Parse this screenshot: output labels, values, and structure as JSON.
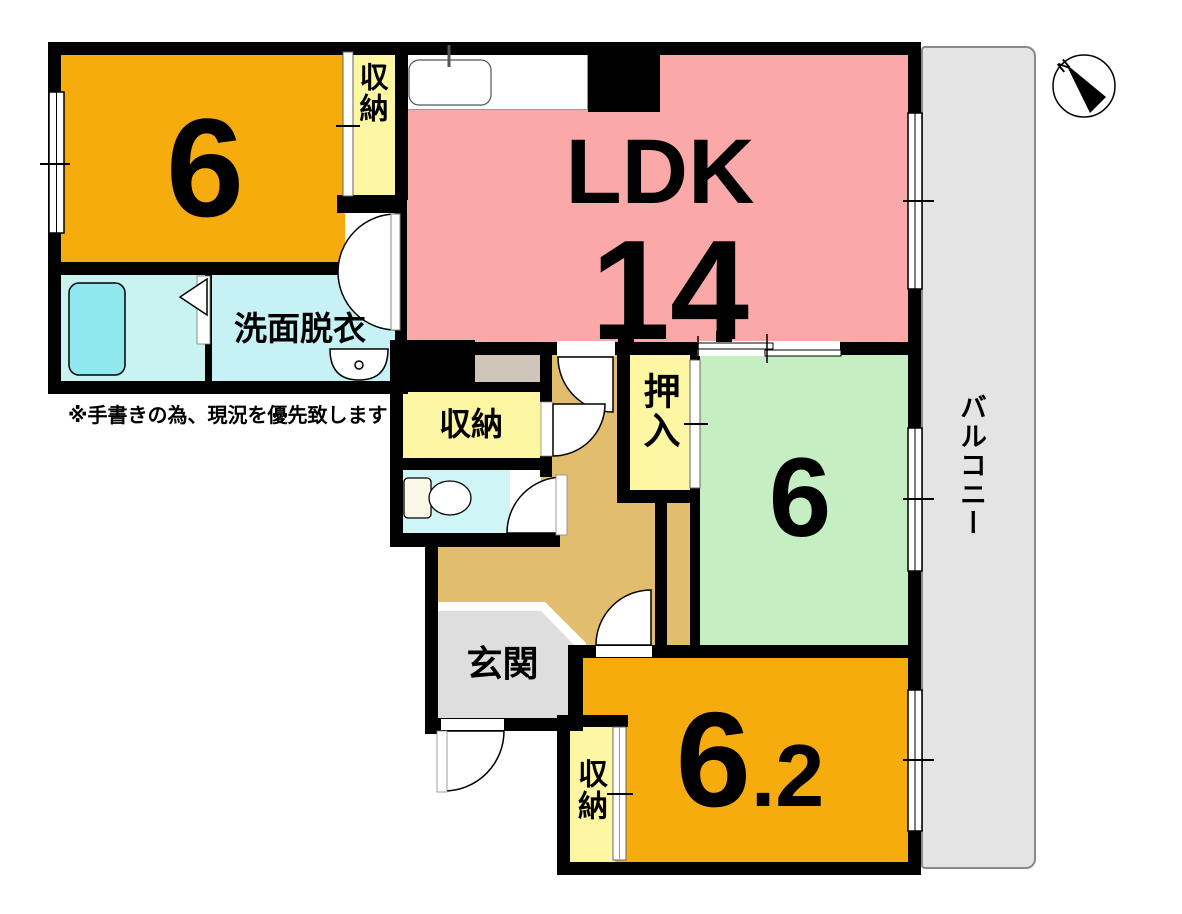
{
  "rooms": {
    "bedroom_nw": {
      "label": "6"
    },
    "closet_nw": {
      "label": "収納"
    },
    "ldk": {
      "label": "LDK",
      "size": "14"
    },
    "washroom": {
      "label": "洗面脱衣"
    },
    "closet_mid": {
      "label": "収納"
    },
    "oshiire": {
      "label": "押入"
    },
    "bedroom_east": {
      "label": "6"
    },
    "balcony": {
      "label": "バルコニー"
    },
    "genkan": {
      "label": "玄関"
    },
    "closet_south": {
      "label": "収納"
    },
    "bedroom_south": {
      "label_main": "6",
      "label_decimal": ".2"
    }
  },
  "annotations": {
    "note": "※手書きの為、現況を優先致します",
    "compass_north": "N"
  },
  "colors": {
    "wall": "#000000",
    "bedroom_orange": "#F7AC0E",
    "ldk_pink": "#FBA8A8",
    "room_green": "#C5EFC3",
    "closet_yellow": "#FDF6A3",
    "hallway_tan": "#E2BD6E",
    "step_gray": "#CFC5B8",
    "genkan_gray": "#DEDEDE",
    "balcony_gray": "#E4E4E4",
    "bath_cyan": "#C9F3F3",
    "tub_cyan": "#8FE8EE",
    "washroom_cyan": "#C6F2F5",
    "toilet_cyan": "#D0F5F7"
  }
}
